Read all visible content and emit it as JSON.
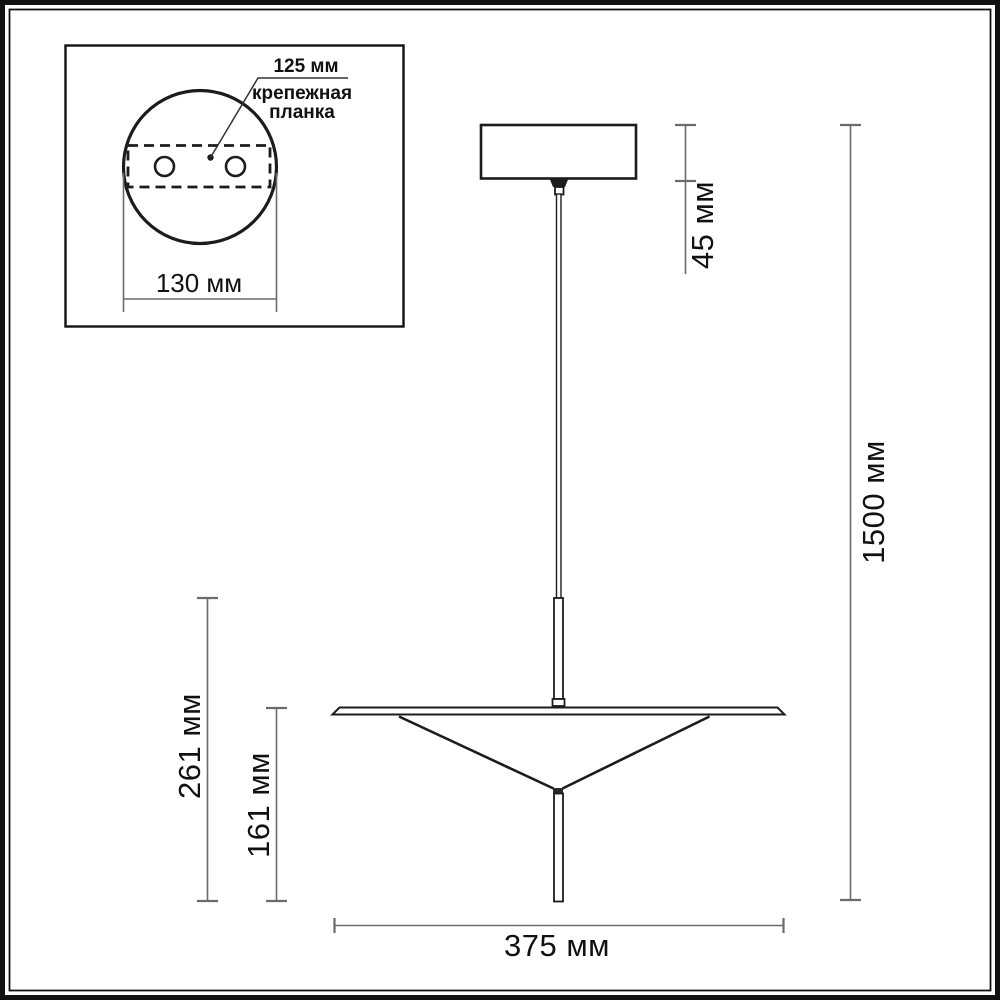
{
  "inset": {
    "hole_spacing_label": "125 мм",
    "mounting_plate_label_line1": "крепежная",
    "mounting_plate_label_line2": "планка",
    "plate_width_label": "130 мм"
  },
  "dimensions": {
    "canopy_drop_label": "45 мм",
    "overall_height_label": "1500 мм",
    "fixture_height_label": "261 мм",
    "shade_height_label": "161 мм",
    "shade_width_label": "375 мм"
  },
  "colors": {
    "ink": "#1c1c1c",
    "dim_line": "#6b6b6b",
    "background": "#ffffff"
  }
}
